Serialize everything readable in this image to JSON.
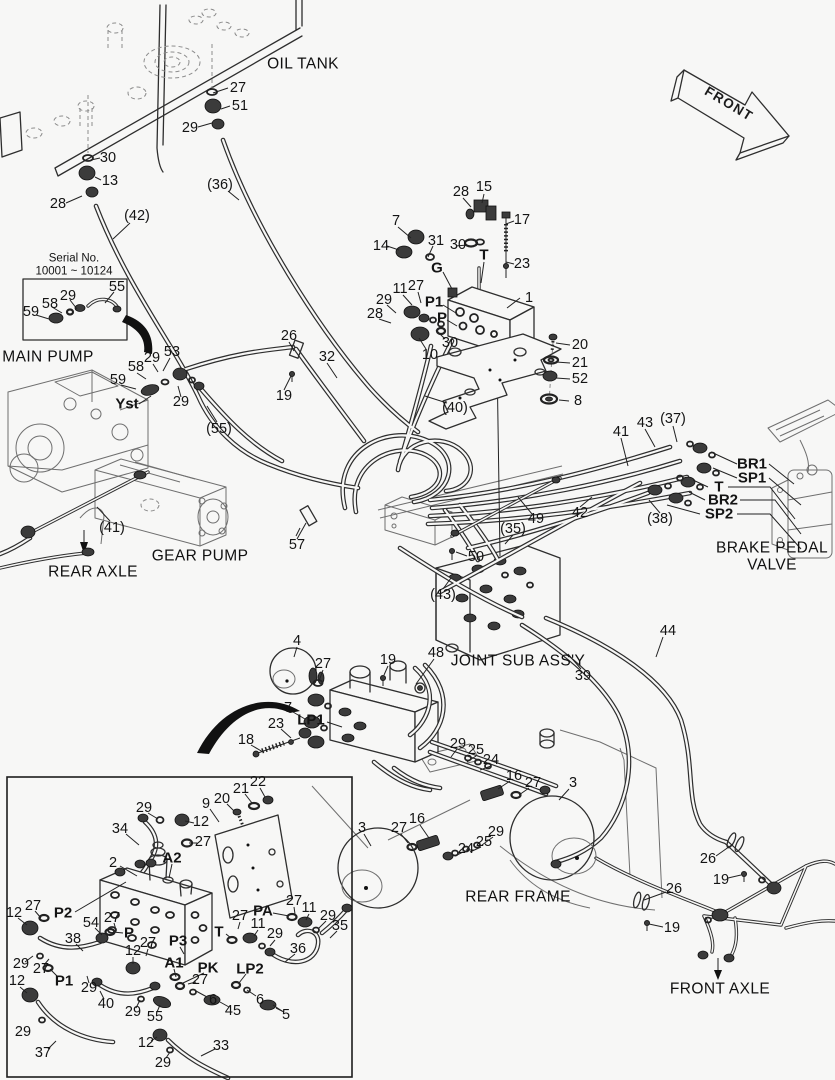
{
  "figure": {
    "type": "hydraulic-piping-parts-diagram",
    "serial_note": [
      "Serial No.",
      "10001 ~ 10124"
    ],
    "direction_arrow": "FRONT",
    "component_names": [
      "OIL TANK",
      "MAIN PUMP",
      "GEAR PUMP",
      "REAR AXLE",
      "BRAKE PEDAL VALVE",
      "JOINT SUB ASS'Y",
      "REAR FRAME",
      "FRONT AXLE"
    ],
    "port_names": [
      "Yst",
      "G",
      "T",
      "P",
      "P1",
      "P2",
      "P3",
      "PA",
      "PK",
      "A1",
      "A2",
      "LP1",
      "LP2",
      "BR1",
      "SP1",
      "BR2",
      "SP2"
    ]
  },
  "callouts": [
    {
      "t": "OIL TANK",
      "x": 303,
      "y": 64,
      "c": "big"
    },
    {
      "t": "MAIN PUMP",
      "x": 48,
      "y": 357,
      "c": "big"
    },
    {
      "t": "GEAR PUMP",
      "x": 200,
      "y": 556,
      "c": "big"
    },
    {
      "t": "REAR AXLE",
      "x": 93,
      "y": 572,
      "c": "big"
    },
    {
      "t": "BRAKE PEDAL",
      "x": 772,
      "y": 548,
      "c": "big"
    },
    {
      "t": "VALVE",
      "x": 772,
      "y": 565,
      "c": "big"
    },
    {
      "t": "JOINT SUB ASS'Y",
      "x": 518,
      "y": 661,
      "c": "big"
    },
    {
      "t": "REAR FRAME",
      "x": 518,
      "y": 897,
      "c": "big"
    },
    {
      "t": "FRONT AXLE",
      "x": 720,
      "y": 989,
      "c": "big"
    },
    {
      "t": "Serial No.",
      "x": 74,
      "y": 259,
      "c": "small"
    },
    {
      "t": "10001 ~ 10124",
      "x": 74,
      "y": 272,
      "c": "small"
    },
    {
      "t": "FRONT",
      "x": 729,
      "y": 104,
      "c": "front"
    },
    {
      "t": "27",
      "x": 238,
      "y": 88
    },
    {
      "t": "51",
      "x": 240,
      "y": 106
    },
    {
      "t": "29",
      "x": 190,
      "y": 128
    },
    {
      "t": "(36)",
      "x": 220,
      "y": 185
    },
    {
      "t": "30",
      "x": 108,
      "y": 158
    },
    {
      "t": "13",
      "x": 110,
      "y": 181
    },
    {
      "t": "28",
      "x": 58,
      "y": 204
    },
    {
      "t": "(42)",
      "x": 137,
      "y": 216
    },
    {
      "t": "55",
      "x": 117,
      "y": 287
    },
    {
      "t": "29",
      "x": 68,
      "y": 296
    },
    {
      "t": "58",
      "x": 50,
      "y": 304
    },
    {
      "t": "59",
      "x": 31,
      "y": 312
    },
    {
      "t": "53",
      "x": 172,
      "y": 352
    },
    {
      "t": "29",
      "x": 152,
      "y": 358
    },
    {
      "t": "58",
      "x": 136,
      "y": 367
    },
    {
      "t": "59",
      "x": 118,
      "y": 380
    },
    {
      "t": "Yst",
      "x": 127,
      "y": 404,
      "c": "bold"
    },
    {
      "t": "29",
      "x": 181,
      "y": 402
    },
    {
      "t": "(55)",
      "x": 219,
      "y": 429
    },
    {
      "t": "28",
      "x": 461,
      "y": 192
    },
    {
      "t": "15",
      "x": 484,
      "y": 187
    },
    {
      "t": "7",
      "x": 396,
      "y": 221
    },
    {
      "t": "14",
      "x": 381,
      "y": 246
    },
    {
      "t": "31",
      "x": 436,
      "y": 241
    },
    {
      "t": "30",
      "x": 458,
      "y": 245
    },
    {
      "t": "17",
      "x": 522,
      "y": 220
    },
    {
      "t": "T",
      "x": 484,
      "y": 255,
      "c": "bold"
    },
    {
      "t": "23",
      "x": 522,
      "y": 264
    },
    {
      "t": "G",
      "x": 437,
      "y": 268,
      "c": "bold"
    },
    {
      "t": "11",
      "x": 400,
      "y": 289
    },
    {
      "t": "27",
      "x": 416,
      "y": 286
    },
    {
      "t": "P1",
      "x": 434,
      "y": 302,
      "c": "bold"
    },
    {
      "t": "29",
      "x": 384,
      "y": 300
    },
    {
      "t": "28",
      "x": 375,
      "y": 314
    },
    {
      "t": "P",
      "x": 442,
      "y": 318,
      "c": "bold"
    },
    {
      "t": "30",
      "x": 450,
      "y": 343
    },
    {
      "t": "10",
      "x": 430,
      "y": 355
    },
    {
      "t": "1",
      "x": 529,
      "y": 298
    },
    {
      "t": "20",
      "x": 580,
      "y": 345
    },
    {
      "t": "21",
      "x": 580,
      "y": 363
    },
    {
      "t": "52",
      "x": 580,
      "y": 379
    },
    {
      "t": "8",
      "x": 578,
      "y": 401
    },
    {
      "t": "(40)",
      "x": 455,
      "y": 408
    },
    {
      "t": "26",
      "x": 289,
      "y": 336
    },
    {
      "t": "32",
      "x": 327,
      "y": 357
    },
    {
      "t": "19",
      "x": 284,
      "y": 396
    },
    {
      "t": "41",
      "x": 621,
      "y": 432
    },
    {
      "t": "43",
      "x": 645,
      "y": 423
    },
    {
      "t": "(37)",
      "x": 673,
      "y": 419
    },
    {
      "t": "BR1",
      "x": 752,
      "y": 464,
      "c": "bold"
    },
    {
      "t": "SP1",
      "x": 752,
      "y": 478,
      "c": "bold"
    },
    {
      "t": "T",
      "x": 719,
      "y": 487,
      "c": "bold"
    },
    {
      "t": "BR2",
      "x": 723,
      "y": 500,
      "c": "bold"
    },
    {
      "t": "SP2",
      "x": 719,
      "y": 514,
      "c": "bold"
    },
    {
      "t": "(38)",
      "x": 660,
      "y": 519
    },
    {
      "t": "42",
      "x": 580,
      "y": 513
    },
    {
      "t": "(41)",
      "x": 112,
      "y": 528
    },
    {
      "t": "57",
      "x": 297,
      "y": 545
    },
    {
      "t": "49",
      "x": 536,
      "y": 519
    },
    {
      "t": "(35)",
      "x": 513,
      "y": 529
    },
    {
      "t": "50",
      "x": 476,
      "y": 557
    },
    {
      "t": "(43)",
      "x": 443,
      "y": 595
    },
    {
      "t": "44",
      "x": 668,
      "y": 631
    },
    {
      "t": "39",
      "x": 583,
      "y": 676
    },
    {
      "t": "48",
      "x": 436,
      "y": 653
    },
    {
      "t": "4",
      "x": 297,
      "y": 641
    },
    {
      "t": "27",
      "x": 323,
      "y": 664
    },
    {
      "t": "19",
      "x": 388,
      "y": 660
    },
    {
      "t": "7",
      "x": 288,
      "y": 708
    },
    {
      "t": "LP1",
      "x": 311,
      "y": 720,
      "c": "bold"
    },
    {
      "t": "23",
      "x": 276,
      "y": 724
    },
    {
      "t": "18",
      "x": 246,
      "y": 740
    },
    {
      "t": "29",
      "x": 458,
      "y": 744
    },
    {
      "t": "25",
      "x": 476,
      "y": 750
    },
    {
      "t": "24",
      "x": 491,
      "y": 760
    },
    {
      "t": "16",
      "x": 514,
      "y": 776
    },
    {
      "t": "27",
      "x": 533,
      "y": 783
    },
    {
      "t": "3",
      "x": 573,
      "y": 783
    },
    {
      "t": "3",
      "x": 362,
      "y": 828
    },
    {
      "t": "27",
      "x": 399,
      "y": 828
    },
    {
      "t": "16",
      "x": 417,
      "y": 819
    },
    {
      "t": "24",
      "x": 466,
      "y": 849
    },
    {
      "t": "25",
      "x": 484,
      "y": 842
    },
    {
      "t": "29",
      "x": 496,
      "y": 832
    },
    {
      "t": "26",
      "x": 708,
      "y": 859
    },
    {
      "t": "19",
      "x": 721,
      "y": 880
    },
    {
      "t": "26",
      "x": 674,
      "y": 889
    },
    {
      "t": "19",
      "x": 672,
      "y": 928
    },
    {
      "t": "29",
      "x": 144,
      "y": 808
    },
    {
      "t": "34",
      "x": 120,
      "y": 829
    },
    {
      "t": "2",
      "x": 113,
      "y": 863
    },
    {
      "t": "12",
      "x": 201,
      "y": 822
    },
    {
      "t": "27",
      "x": 203,
      "y": 842
    },
    {
      "t": "22",
      "x": 258,
      "y": 782
    },
    {
      "t": "21",
      "x": 241,
      "y": 789
    },
    {
      "t": "20",
      "x": 222,
      "y": 799
    },
    {
      "t": "9",
      "x": 206,
      "y": 804
    },
    {
      "t": "A2",
      "x": 172,
      "y": 858,
      "c": "bold"
    },
    {
      "t": "PA",
      "x": 263,
      "y": 911,
      "c": "bold"
    },
    {
      "t": "27",
      "x": 294,
      "y": 901
    },
    {
      "t": "11",
      "x": 309,
      "y": 908
    },
    {
      "t": "29",
      "x": 328,
      "y": 916
    },
    {
      "t": "35",
      "x": 340,
      "y": 926
    },
    {
      "t": "T",
      "x": 219,
      "y": 932,
      "c": "bold"
    },
    {
      "t": "27",
      "x": 240,
      "y": 916
    },
    {
      "t": "11",
      "x": 258,
      "y": 924
    },
    {
      "t": "29",
      "x": 275,
      "y": 934
    },
    {
      "t": "36",
      "x": 298,
      "y": 949
    },
    {
      "t": "12",
      "x": 14,
      "y": 913
    },
    {
      "t": "27",
      "x": 33,
      "y": 906
    },
    {
      "t": "P2",
      "x": 63,
      "y": 913,
      "c": "bold"
    },
    {
      "t": "54",
      "x": 91,
      "y": 923
    },
    {
      "t": "27",
      "x": 112,
      "y": 918
    },
    {
      "t": "P",
      "x": 129,
      "y": 933,
      "c": "bold"
    },
    {
      "t": "38",
      "x": 73,
      "y": 939
    },
    {
      "t": "29",
      "x": 21,
      "y": 964
    },
    {
      "t": "27",
      "x": 41,
      "y": 969
    },
    {
      "t": "P1",
      "x": 64,
      "y": 981,
      "c": "bold"
    },
    {
      "t": "12",
      "x": 17,
      "y": 981
    },
    {
      "t": "29",
      "x": 89,
      "y": 988
    },
    {
      "t": "40",
      "x": 106,
      "y": 1004
    },
    {
      "t": "12",
      "x": 133,
      "y": 951
    },
    {
      "t": "27",
      "x": 148,
      "y": 943
    },
    {
      "t": "P3",
      "x": 178,
      "y": 941,
      "c": "bold"
    },
    {
      "t": "A1",
      "x": 174,
      "y": 963,
      "c": "bold"
    },
    {
      "t": "27",
      "x": 200,
      "y": 980
    },
    {
      "t": "PK",
      "x": 208,
      "y": 968,
      "c": "bold"
    },
    {
      "t": "LP2",
      "x": 250,
      "y": 969,
      "c": "bold"
    },
    {
      "t": "6",
      "x": 213,
      "y": 1000
    },
    {
      "t": "45",
      "x": 233,
      "y": 1011
    },
    {
      "t": "6",
      "x": 260,
      "y": 1000
    },
    {
      "t": "5",
      "x": 286,
      "y": 1015
    },
    {
      "t": "29",
      "x": 133,
      "y": 1012
    },
    {
      "t": "55",
      "x": 155,
      "y": 1017
    },
    {
      "t": "12",
      "x": 146,
      "y": 1043
    },
    {
      "t": "29",
      "x": 163,
      "y": 1063
    },
    {
      "t": "33",
      "x": 221,
      "y": 1046
    },
    {
      "t": "37",
      "x": 43,
      "y": 1053
    },
    {
      "t": "29",
      "x": 23,
      "y": 1032
    }
  ]
}
